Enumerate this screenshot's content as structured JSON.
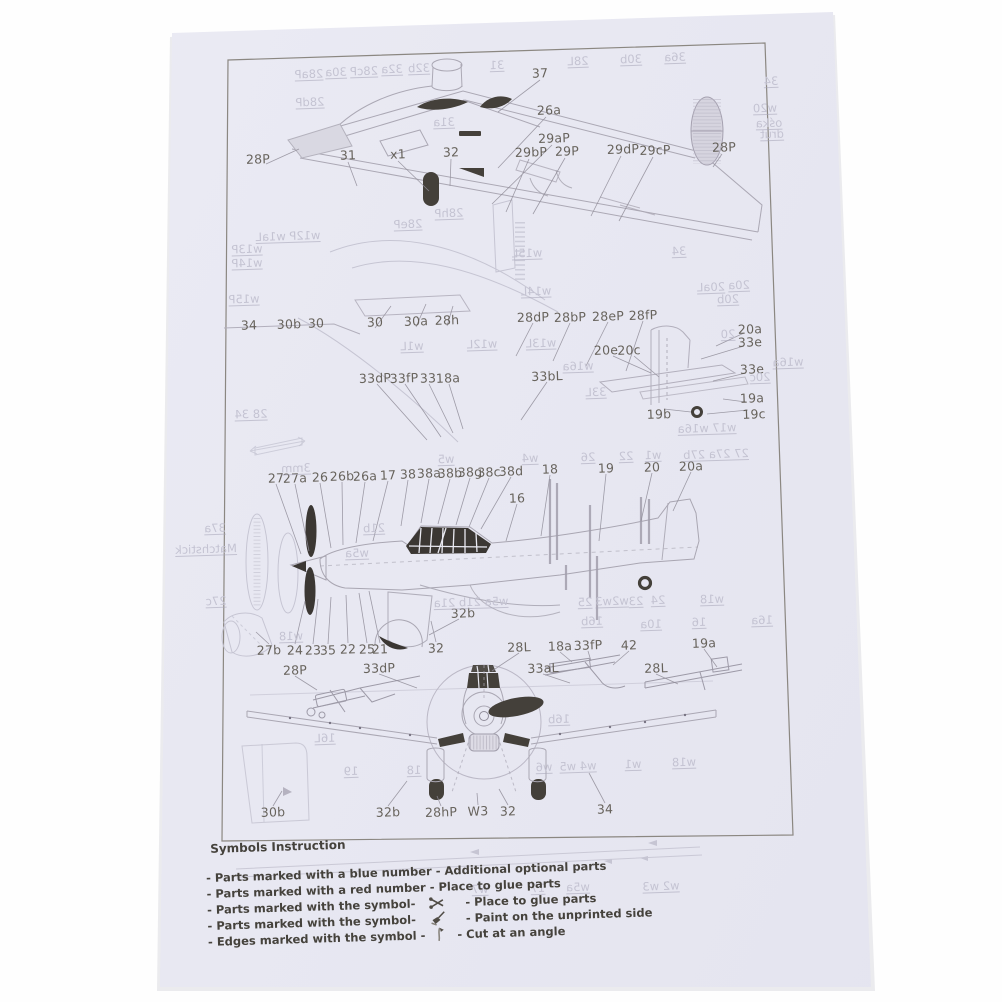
{
  "photo": {
    "width": 1002,
    "height": 1002,
    "background": "#ffffff"
  },
  "paper": {
    "color": "#e8e8f2"
  },
  "colors": {
    "ink": "#5d5850",
    "faint_ink": "#c4c3d2",
    "dark_fill": "#44403a",
    "line": "#aaa7b3",
    "legend_text": "#45423c"
  },
  "legend": {
    "title": "Symbols Instruction",
    "items": [
      {
        "prefix": "- Parts marked with a blue number",
        "symbol": "",
        "suffix": "- Additional optional parts"
      },
      {
        "prefix": "- Parts marked with a red number",
        "symbol": "",
        "suffix": "- Place to glue parts"
      },
      {
        "prefix": "- Parts marked with the symbol-",
        "symbol": "glue-symbol-icon",
        "suffix": "- Place to glue parts"
      },
      {
        "prefix": "- Parts marked with the symbol-",
        "symbol": "paint-symbol-icon",
        "suffix": "- Paint on the unprinted side"
      },
      {
        "prefix": "- Edges marked with the symbol -",
        "symbol": "cut-symbol-icon",
        "suffix": "- Cut at an angle"
      }
    ]
  },
  "labels": {
    "parts": [
      {
        "text": "37",
        "x": 540,
        "y": 73
      },
      {
        "text": "26a",
        "x": 549,
        "y": 110
      },
      {
        "text": "29aP",
        "x": 554,
        "y": 138
      },
      {
        "text": "29bP",
        "x": 531,
        "y": 152
      },
      {
        "text": "29P",
        "x": 567,
        "y": 151
      },
      {
        "text": "29dP",
        "x": 623,
        "y": 149
      },
      {
        "text": "29cP",
        "x": 655,
        "y": 150
      },
      {
        "text": "28P",
        "x": 724,
        "y": 147
      },
      {
        "text": "28P",
        "x": 258,
        "y": 159
      },
      {
        "text": "31",
        "x": 348,
        "y": 155
      },
      {
        "text": "x1",
        "x": 398,
        "y": 154
      },
      {
        "text": "32",
        "x": 451,
        "y": 152
      },
      {
        "text": "34",
        "x": 249,
        "y": 325
      },
      {
        "text": "30b",
        "x": 289,
        "y": 324
      },
      {
        "text": "30",
        "x": 316,
        "y": 323
      },
      {
        "text": "30",
        "x": 375,
        "y": 322
      },
      {
        "text": "30a",
        "x": 416,
        "y": 321
      },
      {
        "text": "28h",
        "x": 447,
        "y": 320
      },
      {
        "text": "28dP",
        "x": 533,
        "y": 317
      },
      {
        "text": "28bP",
        "x": 570,
        "y": 317
      },
      {
        "text": "28eP",
        "x": 608,
        "y": 316
      },
      {
        "text": "28fP",
        "x": 643,
        "y": 315
      },
      {
        "text": "20a",
        "x": 750,
        "y": 329
      },
      {
        "text": "33e",
        "x": 750,
        "y": 342
      },
      {
        "text": "20e",
        "x": 606,
        "y": 350
      },
      {
        "text": "20c",
        "x": 629,
        "y": 350
      },
      {
        "text": "33e",
        "x": 752,
        "y": 369
      },
      {
        "text": "19a",
        "x": 752,
        "y": 398
      },
      {
        "text": "19b",
        "x": 659,
        "y": 414
      },
      {
        "text": "19c",
        "x": 754,
        "y": 414
      },
      {
        "text": "33dP",
        "x": 375,
        "y": 378
      },
      {
        "text": "33fP",
        "x": 404,
        "y": 378
      },
      {
        "text": "33",
        "x": 428,
        "y": 378
      },
      {
        "text": "18a",
        "x": 448,
        "y": 378
      },
      {
        "text": "33bL",
        "x": 547,
        "y": 376
      },
      {
        "text": "27",
        "x": 276,
        "y": 478
      },
      {
        "text": "27a",
        "x": 295,
        "y": 478
      },
      {
        "text": "26",
        "x": 320,
        "y": 477
      },
      {
        "text": "26b",
        "x": 342,
        "y": 476
      },
      {
        "text": "26a",
        "x": 365,
        "y": 476
      },
      {
        "text": "17",
        "x": 388,
        "y": 475
      },
      {
        "text": "38",
        "x": 408,
        "y": 474
      },
      {
        "text": "38a",
        "x": 429,
        "y": 473
      },
      {
        "text": "38b",
        "x": 450,
        "y": 473
      },
      {
        "text": "38g",
        "x": 470,
        "y": 472
      },
      {
        "text": "38c",
        "x": 489,
        "y": 472
      },
      {
        "text": "38d",
        "x": 511,
        "y": 471
      },
      {
        "text": "18",
        "x": 550,
        "y": 469
      },
      {
        "text": "19",
        "x": 606,
        "y": 468
      },
      {
        "text": "20",
        "x": 652,
        "y": 467
      },
      {
        "text": "20a",
        "x": 691,
        "y": 466
      },
      {
        "text": "16",
        "x": 517,
        "y": 498
      },
      {
        "text": "32b",
        "x": 463,
        "y": 613
      },
      {
        "text": "27b",
        "x": 269,
        "y": 650
      },
      {
        "text": "24",
        "x": 295,
        "y": 650
      },
      {
        "text": "23",
        "x": 313,
        "y": 650
      },
      {
        "text": "35",
        "x": 328,
        "y": 650
      },
      {
        "text": "22",
        "x": 348,
        "y": 649
      },
      {
        "text": "25",
        "x": 367,
        "y": 649
      },
      {
        "text": "21",
        "x": 380,
        "y": 649
      },
      {
        "text": "32",
        "x": 436,
        "y": 648
      },
      {
        "text": "28L",
        "x": 519,
        "y": 647
      },
      {
        "text": "18a",
        "x": 560,
        "y": 646
      },
      {
        "text": "33fP",
        "x": 588,
        "y": 645
      },
      {
        "text": "42",
        "x": 629,
        "y": 645
      },
      {
        "text": "19a",
        "x": 704,
        "y": 643
      },
      {
        "text": "28P",
        "x": 295,
        "y": 670
      },
      {
        "text": "33dP",
        "x": 379,
        "y": 668
      },
      {
        "text": "33aL",
        "x": 543,
        "y": 668
      },
      {
        "text": "28L",
        "x": 656,
        "y": 668
      },
      {
        "text": "30b",
        "x": 273,
        "y": 812
      },
      {
        "text": "32b",
        "x": 388,
        "y": 812
      },
      {
        "text": "28hP",
        "x": 441,
        "y": 812
      },
      {
        "text": "W3",
        "x": 478,
        "y": 811
      },
      {
        "text": "32",
        "x": 508,
        "y": 811
      },
      {
        "text": "34",
        "x": 605,
        "y": 809
      }
    ],
    "bleedthrough": [
      {
        "text": "28aP",
        "x": 309,
        "y": 74
      },
      {
        "text": "30a",
        "x": 336,
        "y": 72
      },
      {
        "text": "28cP",
        "x": 364,
        "y": 71
      },
      {
        "text": "32a",
        "x": 392,
        "y": 69
      },
      {
        "text": "32b",
        "x": 419,
        "y": 68
      },
      {
        "text": "31",
        "x": 497,
        "y": 65
      },
      {
        "text": "28L",
        "x": 578,
        "y": 61
      },
      {
        "text": "30b",
        "x": 631,
        "y": 59
      },
      {
        "text": "36a",
        "x": 675,
        "y": 57
      },
      {
        "text": "28dP",
        "x": 310,
        "y": 102
      },
      {
        "text": "31a",
        "x": 444,
        "y": 122
      },
      {
        "text": "34",
        "x": 771,
        "y": 81
      },
      {
        "text": "w20",
        "x": 765,
        "y": 108
      },
      {
        "text": "ośka",
        "x": 769,
        "y": 123
      },
      {
        "text": "drut",
        "x": 772,
        "y": 134
      },
      {
        "text": "w12P w1aL",
        "x": 288,
        "y": 236
      },
      {
        "text": "w13P",
        "x": 247,
        "y": 249
      },
      {
        "text": "w14P",
        "x": 247,
        "y": 263
      },
      {
        "text": "w15P",
        "x": 244,
        "y": 299
      },
      {
        "text": "w15L",
        "x": 527,
        "y": 253
      },
      {
        "text": "w14L",
        "x": 536,
        "y": 291
      },
      {
        "text": "w1L",
        "x": 412,
        "y": 346
      },
      {
        "text": "w12L",
        "x": 482,
        "y": 344
      },
      {
        "text": "w13L",
        "x": 541,
        "y": 343
      },
      {
        "text": "w16a",
        "x": 578,
        "y": 366
      },
      {
        "text": "33L",
        "x": 596,
        "y": 392
      },
      {
        "text": "28 34",
        "x": 251,
        "y": 414
      },
      {
        "text": "34",
        "x": 679,
        "y": 251
      },
      {
        "text": "20aL",
        "x": 711,
        "y": 287
      },
      {
        "text": "20a",
        "x": 739,
        "y": 285
      },
      {
        "text": "20b",
        "x": 728,
        "y": 299
      },
      {
        "text": "20",
        "x": 728,
        "y": 334
      },
      {
        "text": "w16a",
        "x": 788,
        "y": 362
      },
      {
        "text": "20c",
        "x": 760,
        "y": 377
      },
      {
        "text": "28eP",
        "x": 408,
        "y": 224
      },
      {
        "text": "28hP",
        "x": 449,
        "y": 213
      },
      {
        "text": "37a",
        "x": 215,
        "y": 528
      },
      {
        "text": "Matchstick",
        "x": 206,
        "y": 549
      },
      {
        "text": "27c",
        "x": 216,
        "y": 601
      },
      {
        "text": "w18",
        "x": 291,
        "y": 636
      },
      {
        "text": "w17 w16a",
        "x": 707,
        "y": 428
      },
      {
        "text": "27 27a 27b",
        "x": 716,
        "y": 454
      },
      {
        "text": "w5",
        "x": 446,
        "y": 459
      },
      {
        "text": "w4",
        "x": 530,
        "y": 458
      },
      {
        "text": "26",
        "x": 588,
        "y": 457
      },
      {
        "text": "22",
        "x": 626,
        "y": 456
      },
      {
        "text": "w1",
        "x": 653,
        "y": 455
      },
      {
        "text": "3mm",
        "x": 296,
        "y": 468
      },
      {
        "text": "21b",
        "x": 374,
        "y": 528
      },
      {
        "text": "w5a",
        "x": 357,
        "y": 553
      },
      {
        "text": "w5a 21b 21a",
        "x": 471,
        "y": 602
      },
      {
        "text": "25",
        "x": 585,
        "y": 602
      },
      {
        "text": "w2w3",
        "x": 612,
        "y": 601
      },
      {
        "text": "23",
        "x": 636,
        "y": 601
      },
      {
        "text": "24",
        "x": 658,
        "y": 600
      },
      {
        "text": "w18",
        "x": 712,
        "y": 599
      },
      {
        "text": "16b",
        "x": 592,
        "y": 621
      },
      {
        "text": "10a",
        "x": 651,
        "y": 624
      },
      {
        "text": "16",
        "x": 699,
        "y": 622
      },
      {
        "text": "16a",
        "x": 762,
        "y": 620
      },
      {
        "text": "16b",
        "x": 559,
        "y": 719
      },
      {
        "text": "16L",
        "x": 325,
        "y": 738
      },
      {
        "text": "19",
        "x": 351,
        "y": 771
      },
      {
        "text": "18",
        "x": 414,
        "y": 770
      },
      {
        "text": "w6",
        "x": 544,
        "y": 767
      },
      {
        "text": "w4 w5",
        "x": 578,
        "y": 766
      },
      {
        "text": "w1",
        "x": 633,
        "y": 764
      },
      {
        "text": "w18",
        "x": 684,
        "y": 762
      },
      {
        "text": "w7",
        "x": 480,
        "y": 889
      },
      {
        "text": "17",
        "x": 538,
        "y": 888
      },
      {
        "text": "w5a",
        "x": 578,
        "y": 887
      },
      {
        "text": "w2 w3",
        "x": 661,
        "y": 886
      }
    ]
  }
}
